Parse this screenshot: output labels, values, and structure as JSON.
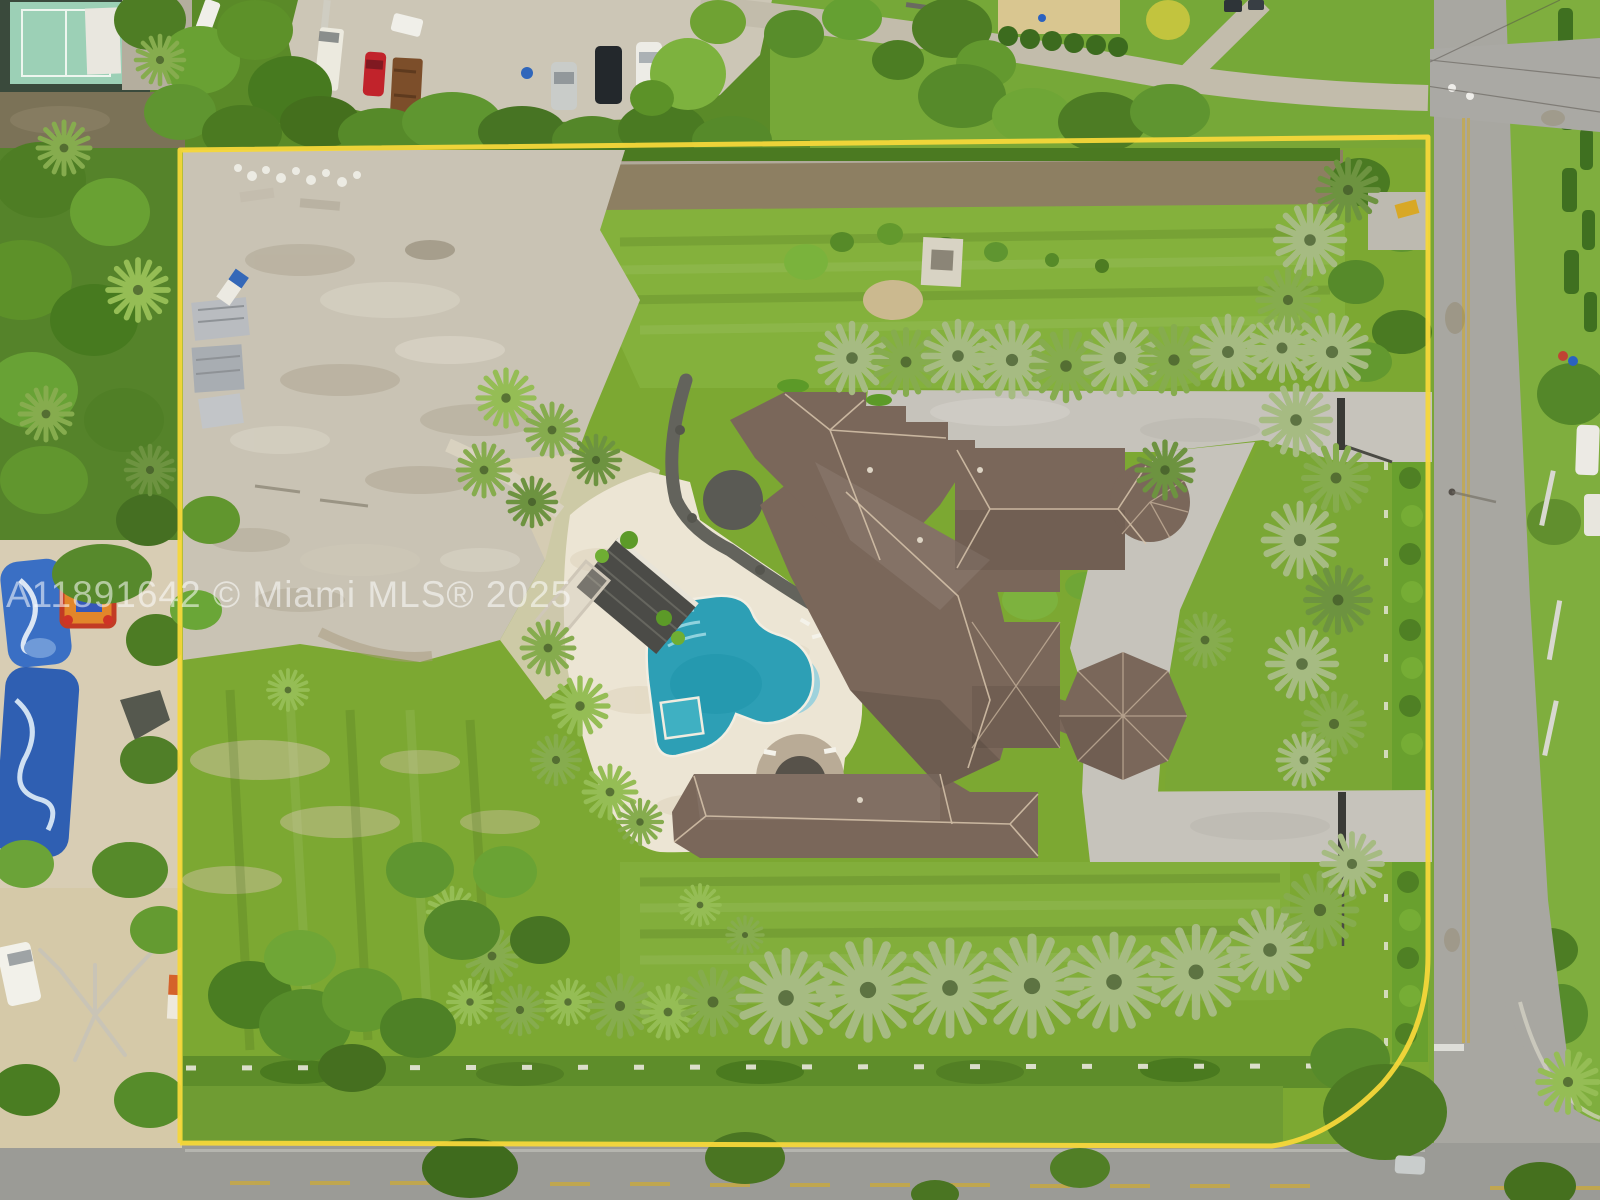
{
  "image": {
    "kind": "aerial-drone-photo",
    "subject": "Large estate lot outlined in yellow with mansion, pool, palm-lined grounds, roads at right and bottom, neighboring properties around",
    "width_px": 1600,
    "height_px": 1200
  },
  "watermark": {
    "text": "A11891642 © Miami MLS® 2025",
    "color": "#ffffff",
    "opacity": 0.55
  },
  "boundary": {
    "label": "property boundary outline",
    "color": "#f6d73a",
    "stroke_width": 5
  },
  "scene": {
    "colors": {
      "lawn": "#7ca832",
      "lawn_bright": "#84b13c",
      "lawn_dark": "#5d8a2b",
      "trees": "#4e7d24",
      "palm_silver": "#a6bb82",
      "concrete_lot": "#c9c3b4",
      "sand": "#d8cdb4",
      "pool_water": "#2d9fb5",
      "pool_shallow": "#9ed2dc",
      "pool_deck": "#ece5d4",
      "roof": "#7a675a",
      "roof_ridge": "#d7c4ab",
      "driveway": "#c6c3bb",
      "road": "#a8a7a1",
      "road_bottom": "#9b9b96",
      "road_center_line": "#c9a93e",
      "cabana": "#4b4b47",
      "tennis_court": "#9cd0b6"
    },
    "features": [
      {
        "name": "property-boundary-line",
        "label": "yellow lot outline"
      },
      {
        "name": "main-house-roof",
        "label": "mansion brown hip roof"
      },
      {
        "name": "octagon-pavilion-roof",
        "label": "octagonal pavilion"
      },
      {
        "name": "square-pavilion-roof",
        "label": "square pavilion"
      },
      {
        "name": "swimming-pool",
        "label": "freeform pool with round swim-out"
      },
      {
        "name": "pool-spa",
        "label": "small square spa"
      },
      {
        "name": "pool-deck",
        "label": "cream paver pool deck"
      },
      {
        "name": "cabana-roof",
        "label": "dark trellis cabana"
      },
      {
        "name": "spa-patio",
        "label": "round patio with fire pit"
      },
      {
        "name": "driveway",
        "label": "gray paver driveway with gated entries"
      },
      {
        "name": "palm-row-middle",
        "label": "row of silver palms across lot"
      },
      {
        "name": "palm-row-bottom",
        "label": "row of large fan palms along south fence"
      },
      {
        "name": "palm-column-right",
        "label": "palm hedge along east side"
      },
      {
        "name": "tennis-court",
        "label": "neighboring sport court top-left"
      },
      {
        "name": "parking-lot",
        "label": "gravel lot with parked vehicles top"
      },
      {
        "name": "right-road",
        "label": "street along east side"
      },
      {
        "name": "bottom-road",
        "label": "street along south side"
      },
      {
        "name": "water-slides",
        "label": "blue inflatable slides on west neighbor lot"
      },
      {
        "name": "bounce-house",
        "label": "colorful bounce house west neighbor"
      }
    ]
  }
}
